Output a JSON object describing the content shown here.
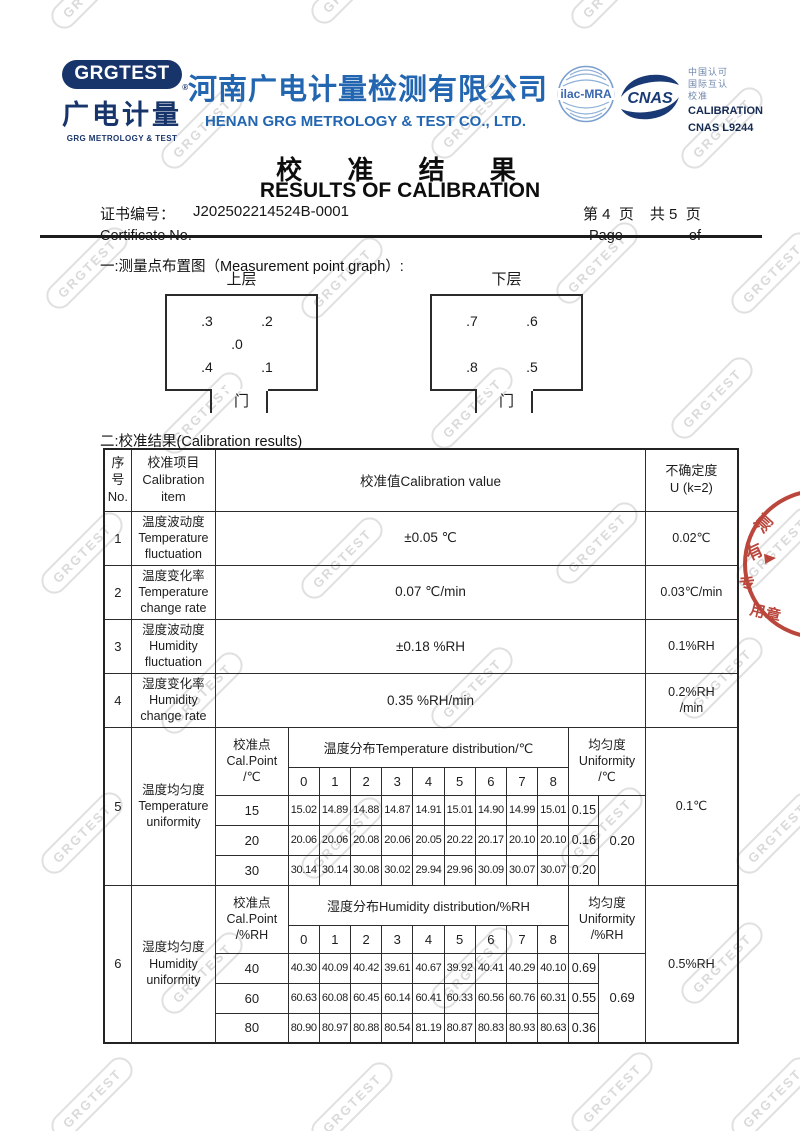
{
  "watermark": {
    "text": "GRGTEST"
  },
  "header": {
    "logo": {
      "pill": "GRGTEST",
      "registered": "®",
      "cn": "广电计量",
      "en": "GRG METROLOGY & TEST"
    },
    "company": {
      "cn": "河南广电计量检测有限公司",
      "en": "HENAN GRG METROLOGY & TEST CO., LTD."
    },
    "accreditation": {
      "ilac": "ilac-MRA",
      "cnas": "CNAS",
      "cn_line1": "中国认可",
      "cn_line2": "国际互认",
      "cn_line3": "校准",
      "en_line1": "CALIBRATION",
      "en_line2": "CNAS L9244"
    }
  },
  "title": {
    "cn": "校 准 结 果",
    "en": "RESULTS OF CALIBRATION"
  },
  "certificate": {
    "label_cn": "证书编号：",
    "number": "J202502214524B-0001",
    "label_en": "Certificate No.",
    "page_group1": "第 4  页",
    "page_group2": "共 5  页",
    "page_en": "Page",
    "of_en": "of"
  },
  "sections": {
    "s1": "一:测量点布置图（Measurement point graph）:",
    "s2": "二:校准结果(Calibration results)"
  },
  "diagram": {
    "upper": {
      "title": "上层",
      "p3": ".3",
      "p2": ".2",
      "p0": ".0",
      "p4": ".4",
      "p1": ".1",
      "door": "门"
    },
    "lower": {
      "title": "下层",
      "p7": ".7",
      "p6": ".6",
      "p8": ".8",
      "p5": ".5",
      "door": "门"
    }
  },
  "table": {
    "header": {
      "no": "序\n号\nNo.",
      "item": "校准项目\nCalibration\nitem",
      "value": "校准值Calibration value",
      "uncertainty": "不确定度\nU (k=2)"
    },
    "rows": [
      {
        "no": "1",
        "item": "温度波动度\nTemperature\nfluctuation",
        "value": "±0.05 ℃",
        "uncertainty": "0.02℃"
      },
      {
        "no": "2",
        "item": "温度变化率\nTemperature\nchange rate",
        "value": "0.07 ℃/min",
        "uncertainty": "0.03℃/min"
      },
      {
        "no": "3",
        "item": "湿度波动度\nHumidity\nfluctuation",
        "value": "±0.18 %RH",
        "uncertainty": "0.1%RH"
      },
      {
        "no": "4",
        "item": "湿度变化率\nHumidity\nchange rate",
        "value": "0.35 %RH/min",
        "uncertainty": "0.2%RH\n/min"
      }
    ],
    "dist_cols": [
      "0",
      "1",
      "2",
      "3",
      "4",
      "5",
      "6",
      "7",
      "8"
    ],
    "temp": {
      "no": "5",
      "item": "温度均匀度\nTemperature\nuniformity",
      "calpoint": "校准点\nCal.Point\n/℃",
      "dist_header": "温度分布Temperature distribution/℃",
      "unif_header": "均匀度\nUniformity\n/℃",
      "rows": [
        {
          "point": "15",
          "values": [
            "15.02",
            "14.89",
            "14.88",
            "14.87",
            "14.91",
            "15.01",
            "14.90",
            "14.99",
            "15.01"
          ],
          "uniformity": "0.15"
        },
        {
          "point": "20",
          "values": [
            "20.06",
            "20.06",
            "20.08",
            "20.06",
            "20.05",
            "20.22",
            "20.17",
            "20.10",
            "20.10"
          ],
          "uniformity": "0.16"
        },
        {
          "point": "30",
          "values": [
            "30.14",
            "30.14",
            "30.08",
            "30.02",
            "29.94",
            "29.96",
            "30.09",
            "30.07",
            "30.07"
          ],
          "uniformity": "0.20"
        }
      ],
      "overall": "0.20",
      "uncertainty": "0.1℃"
    },
    "hum": {
      "no": "6",
      "item": "湿度均匀度\nHumidity\nuniformity",
      "calpoint": "校准点\nCal.Point\n/%RH",
      "dist_header": "湿度分布Humidity distribution/%RH",
      "unif_header": "均匀度\nUniformity\n/%RH",
      "rows": [
        {
          "point": "40",
          "values": [
            "40.30",
            "40.09",
            "40.42",
            "39.61",
            "40.67",
            "39.92",
            "40.41",
            "40.29",
            "40.10"
          ],
          "uniformity": "0.69"
        },
        {
          "point": "60",
          "values": [
            "60.63",
            "60.08",
            "60.45",
            "60.14",
            "60.41",
            "60.33",
            "60.56",
            "60.76",
            "60.31"
          ],
          "uniformity": "0.55"
        },
        {
          "point": "80",
          "values": [
            "80.90",
            "80.97",
            "80.88",
            "80.54",
            "81.19",
            "80.87",
            "80.83",
            "80.93",
            "80.63"
          ],
          "uniformity": "0.36"
        }
      ],
      "overall": "0.69",
      "uncertainty": "0.5%RH"
    }
  },
  "stamp": {
    "char1": "测",
    "char2": "有",
    "char3": "专",
    "char4": "用章"
  }
}
